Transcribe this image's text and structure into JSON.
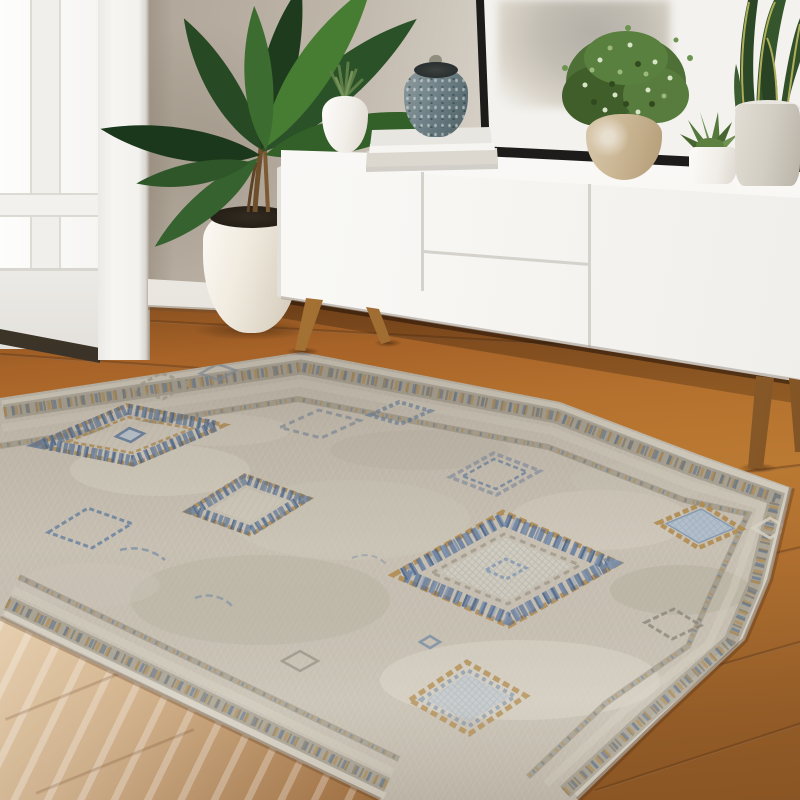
{
  "scene": {
    "kind": "interior lifestyle product photograph",
    "subject": "distressed Moroccan-style area rug in a bright living room",
    "visible_text": "none",
    "wall": {
      "description": "greige wall, brighter toward the right where window light falls",
      "color_left": "#b3a99c",
      "color_right": "#f2f0ec"
    },
    "window_door": {
      "position": "left edge",
      "description": "white glazed door / window with muntins and casing",
      "frame_color": "#f4f3f0",
      "glass_color": "#fbfbfa",
      "threshold_color": "#3c332a"
    },
    "baseboard": {
      "color": "#eceae4"
    },
    "floor": {
      "material": "hardwood planks",
      "tone_mid": "#b4712e",
      "tone_shadow": "#6e3f1b",
      "highlight_corner": "#f2ead9",
      "highlight_position": "bottom-left sunlit patch"
    },
    "sideboard": {
      "style": "mid-century modern credenza",
      "body_color": "#f7f6f3",
      "front_sections": [
        "left door",
        "upper drawer",
        "lower drawer",
        "right door"
      ],
      "legs": {
        "shape": "tapered splayed",
        "material": "wood",
        "color": "#a9763c",
        "visible_count": 4
      }
    },
    "artwork": {
      "placement": "large framed abstract leaning on wall behind sideboard",
      "frame_color": "#1d1c1a",
      "mat_color": "#f3f2ee",
      "art_tones": [
        "#b4afa7",
        "#d8d2c7"
      ]
    },
    "tabletop_items": [
      {
        "name": "mini spiky succulent in round white pot",
        "pot_color": "#f1eee8"
      },
      {
        "name": "stack of two hardcover books",
        "colors": [
          "#e8e6e1",
          "#dcd8d0"
        ]
      },
      {
        "name": "speckled blue-grey ceramic vase with knob lid on books",
        "color": "#75878c"
      },
      {
        "name": "bushy green plant in mottled tan pot",
        "foliage": "#517437",
        "pot_color": "#cbb795"
      },
      {
        "name": "small succulent rosette in white pot",
        "foliage": "#5d8040",
        "pot_color": "#f0ede7"
      },
      {
        "name": "snake plant in grey pot",
        "leaf_dark": "#2c4726",
        "leaf_edge": "#c5bf63",
        "pot_color": "#d3cec4"
      }
    ],
    "floor_plant": {
      "name": "tall tropical palm in cream floor planter",
      "foliage_dark": "#1e3b1d",
      "foliage_light": "#477c33",
      "pot_color": "#efe9dd"
    },
    "rug": {
      "style": "vintage-washed tribal / Moroccan diamond motif",
      "orientation": "rotated diagonally toward viewer",
      "field_color": "#c7c0b3",
      "field_light": "#ddd8cc",
      "field_grey": "#a59e90",
      "accent_blue": "#54719a",
      "accent_light_blue": "#aec0d2",
      "accent_gold": "#b28c50",
      "border": "double geometric beaded band in grey, gold and blue following all edges",
      "motifs": [
        {
          "type": "large beaded diamond medallion",
          "position": "upper left",
          "details": "gold stitched outline, blue checkered band, hatched beige core, small blue center diamond"
        },
        {
          "type": "large beaded diamond medallion",
          "position": "center",
          "details": "gold stitched outline, blue checkered band, crosshatched core"
        },
        {
          "type": "beaded diamond medallion",
          "position": "mid left",
          "details": "partial, blue beads with gold trim"
        },
        {
          "type": "gold-bordered diamond",
          "position": "center right",
          "details": "light blue crosshatch fill"
        },
        {
          "type": "gold-bordered diamond",
          "position": "lower center",
          "details": "light blue fill, blue inner line"
        },
        {
          "type": "thin outline diamond",
          "position": "scattered small accents",
          "details": "sketchy blue, grey and beige outline diamonds and dashes"
        }
      ]
    },
    "lighting": "soft daylight from window at left, bright wash on right wall and bottom-left floor"
  }
}
